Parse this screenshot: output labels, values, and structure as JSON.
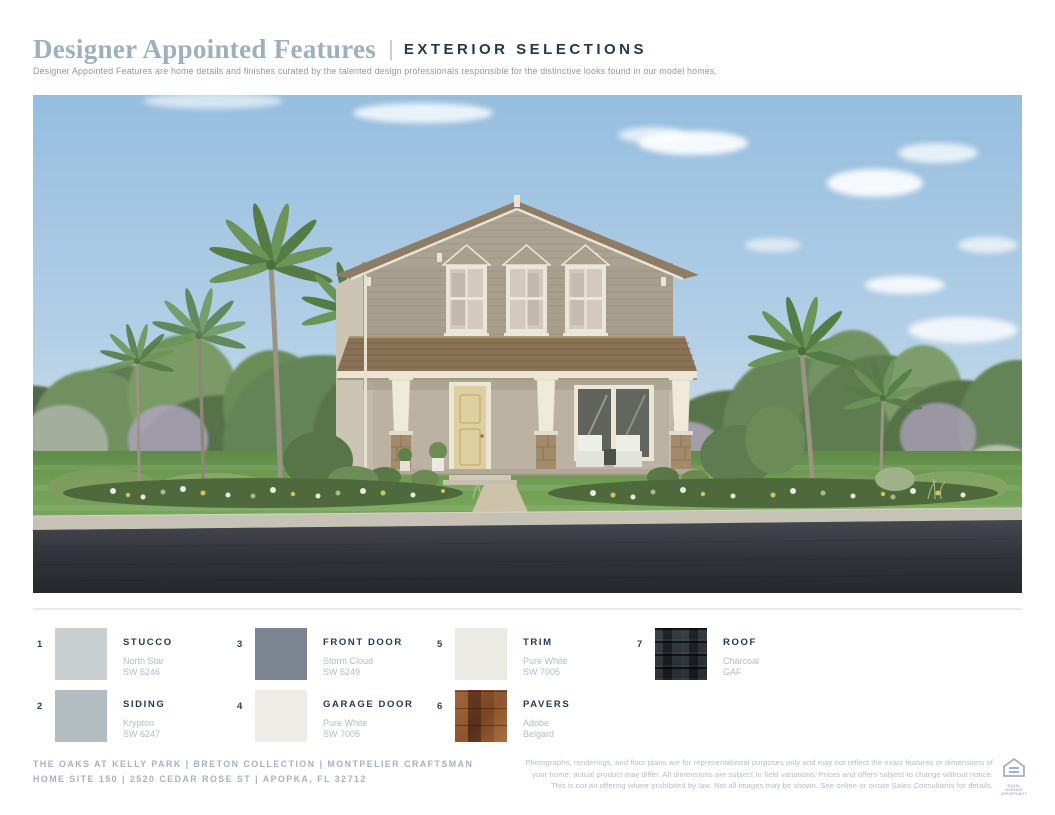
{
  "header": {
    "title": "Designer Appointed Features",
    "sep": "|",
    "tag": "EXTERIOR SELECTIONS",
    "description": "Designer Appointed Features are home details and finishes curated by the talented design professionals responsible for the distinctive looks found in our model homes.",
    "title_color": "#9cb0bd",
    "tag_color": "#21394f"
  },
  "hero": {
    "caption": "Two-story Montpelier Craftsman exterior rendering",
    "sky_color": "#9cc2e0",
    "roof_color": "#8a7256",
    "stucco_color": "#c3baa9",
    "siding_color": "#a89f8f",
    "door_color": "#ddcf9e",
    "lawn_color": "#6f9e52",
    "road_color": "#33363c"
  },
  "selections": [
    {
      "number": "1",
      "label": "STUCCO",
      "name": "North Star",
      "code": "SW 6246",
      "swatch_color": "#c9ced1"
    },
    {
      "number": "2",
      "label": "SIDING",
      "name": "Krypton",
      "code": "SW 6247",
      "swatch_color": "#b3bcc1"
    },
    {
      "number": "3",
      "label": "FRONT DOOR",
      "name": "Storm Cloud",
      "code": "SW 6249",
      "swatch_color": "#7d8491"
    },
    {
      "number": "4",
      "label": "GARAGE DOOR",
      "name": "Pure White",
      "code": "SW 7005",
      "swatch_color": "#edece6"
    },
    {
      "number": "5",
      "label": "TRIM",
      "name": "Pure White",
      "code": "SW 7005",
      "swatch_color": "#eceae4"
    },
    {
      "number": "6",
      "label": "PAVERS",
      "name": "Adobe",
      "code": "Belgard",
      "texture": "pavers"
    },
    {
      "number": "7",
      "label": "ROOF",
      "name": "Charcoal",
      "code": "GAF",
      "texture": "roof"
    }
  ],
  "footer": {
    "line1": "THE OAKS AT KELLY PARK | BRETON COLLECTION | MONTPELIER CRAFTSMAN",
    "line2": "HOME SITE 150 | 2520 CEDAR ROSE ST | APOPKA, FL 32712",
    "disclaimer": [
      "Photographs, renderings, and floor plans are for representational purposes only and may not reflect the exact features or dimensions of",
      "your home; actual product may differ. All dimensions are subject to field variations. Prices and offers subject to change without notice.",
      "This is not an offering where prohibited by law. Not all images may be shown. See online or onsite Sales Consultants for details."
    ],
    "equal_housing_label": "EQUAL HOUSING OPPORTUNITY"
  }
}
